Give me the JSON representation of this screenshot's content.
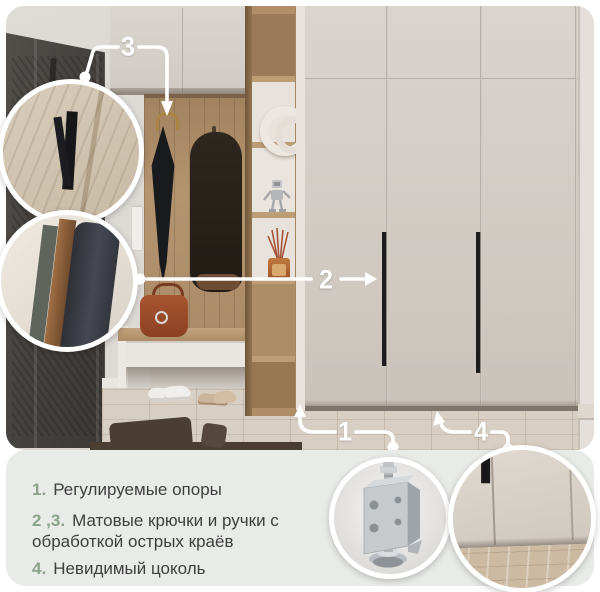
{
  "legend": {
    "items": [
      {
        "num": "1.",
        "text": "Регулируемые опоры"
      },
      {
        "num": "2 ,3.",
        "text": "Матовые крючки и ручки с\nобработкой острых краёв"
      },
      {
        "num": "4.",
        "text": "Невидимый цоколь"
      }
    ]
  },
  "callouts": {
    "c1": "1",
    "c2": "2",
    "c3": "3",
    "c4": "4"
  },
  "insets": {
    "hook": "matte-hook-closeup",
    "handle_edge": "handle-edge-closeup",
    "foot": "adjustable-foot-closeup",
    "plinth": "invisible-plinth-closeup"
  },
  "colors": {
    "accent_green": "#8aa38a",
    "legend_text": "#3e3e3e",
    "panel_bg": "#e9ebe9",
    "callout": "#ffffff",
    "wardrobe": "#d5cfc9",
    "wood": "#ab8b66",
    "door": "#46423f",
    "floor": "#d8cfc4",
    "rug": "#4a3e33",
    "black_accent": "#1a1a1c"
  }
}
